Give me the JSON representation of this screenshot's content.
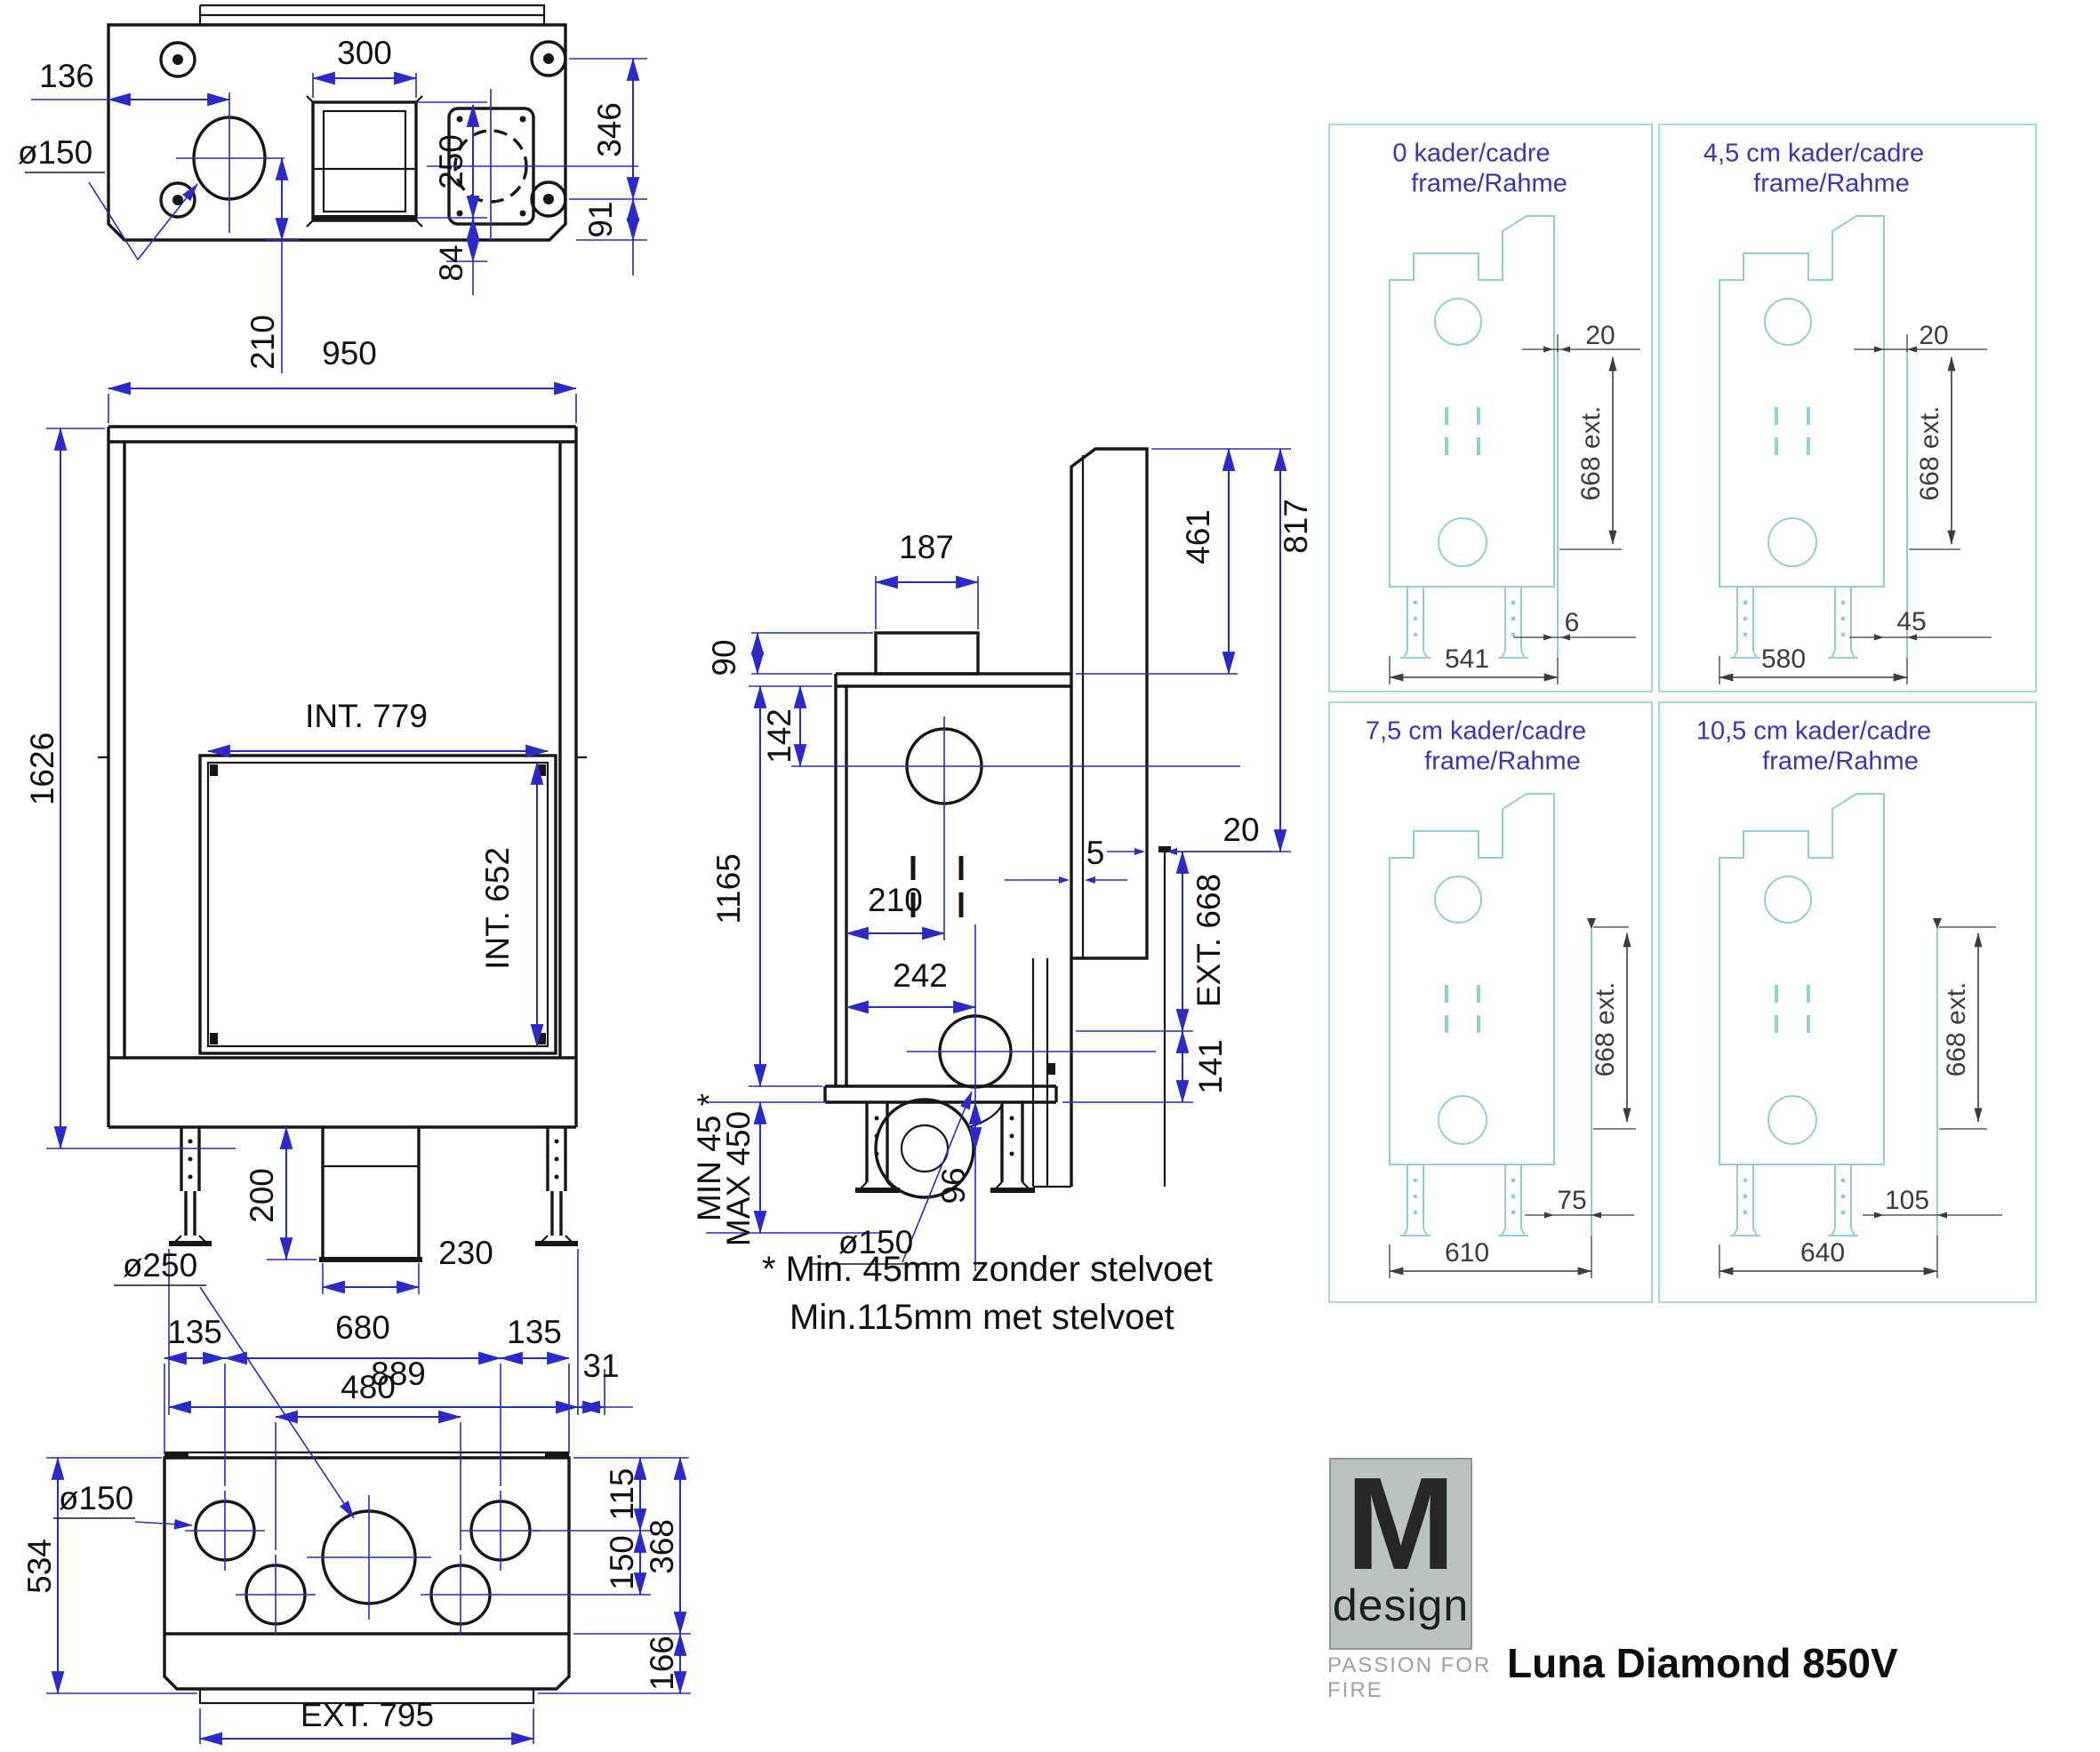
{
  "product": {
    "name": "Luna Diamond 850V"
  },
  "brand": {
    "letter": "M",
    "word": "design",
    "tagline": "PASSION FOR FIRE"
  },
  "views": {
    "top": {
      "dims": {
        "left_to_flue": "136",
        "flue_dia": "ø150",
        "duct_width": "300",
        "duct_depth": "250",
        "duct_offset": "84",
        "depth": "346",
        "rear_offset": "91",
        "flue_from_front": "210"
      }
    },
    "front": {
      "dims": {
        "width": "950",
        "total_height": "1626",
        "int_width": "INT. 779",
        "int_height": "INT. 652",
        "duct_height": "200",
        "duct_width": "230",
        "feet_span": "889",
        "side_offset": "31"
      }
    },
    "side": {
      "dims": {
        "duct_width": "187",
        "duct_height": "90",
        "flue_from_top": "142",
        "flue_from_front": "210",
        "chimney_top": "461",
        "chimney_height": "817",
        "frame_gap": "20",
        "body_height": "1165",
        "lower_flue": "242",
        "glass_gap": "5",
        "ext_height": "EXT. 668",
        "bottom_offset": "141",
        "blower_drop": "96",
        "min_clearance": "MIN 45 *",
        "max_clearance": "MAX 450",
        "flue_dia": "ø150"
      },
      "note1": "* Min. 45mm zonder stelvoet",
      "note2": "Min.115mm met stelvoet"
    },
    "bottom": {
      "dims": {
        "big_dia": "ø250",
        "margin_left": "135",
        "center_span": "680",
        "margin_right": "135",
        "inner_span": "480",
        "small_dia": "ø150",
        "depth_total": "534",
        "top_offset": "115",
        "row_gap": "150",
        "body_depth": "368",
        "base_depth": "166",
        "ext_width": "EXT. 795"
      }
    }
  },
  "frames": {
    "q1": {
      "title1": "0  kader/cadre",
      "title2": "frame/Rahme",
      "gap": "20",
      "ext": "668 ext.",
      "offset": "6",
      "width": "541"
    },
    "q2": {
      "title1": "4,5 cm  kader/cadre",
      "title2": "frame/Rahme",
      "gap": "20",
      "ext": "668 ext.",
      "offset": "45",
      "width": "580"
    },
    "q3": {
      "title1": "7,5 cm kader/cadre",
      "title2": "frame/Rahme",
      "ext": "668 ext.",
      "offset": "75",
      "width": "610"
    },
    "q4": {
      "title1": "10,5 cm kader/cadre",
      "title2": "frame/Rahme",
      "ext": "668 ext.",
      "offset": "105",
      "width": "640"
    }
  },
  "colors": {
    "line": "#161616",
    "dimension": "#2a2ac8",
    "panel_line": "#8fcfd6",
    "panel_label": "#3a34b8",
    "panel_dim": "#3c3c3c",
    "logo_bg": "#bac4be",
    "logo_tag": "#9aa39d"
  }
}
